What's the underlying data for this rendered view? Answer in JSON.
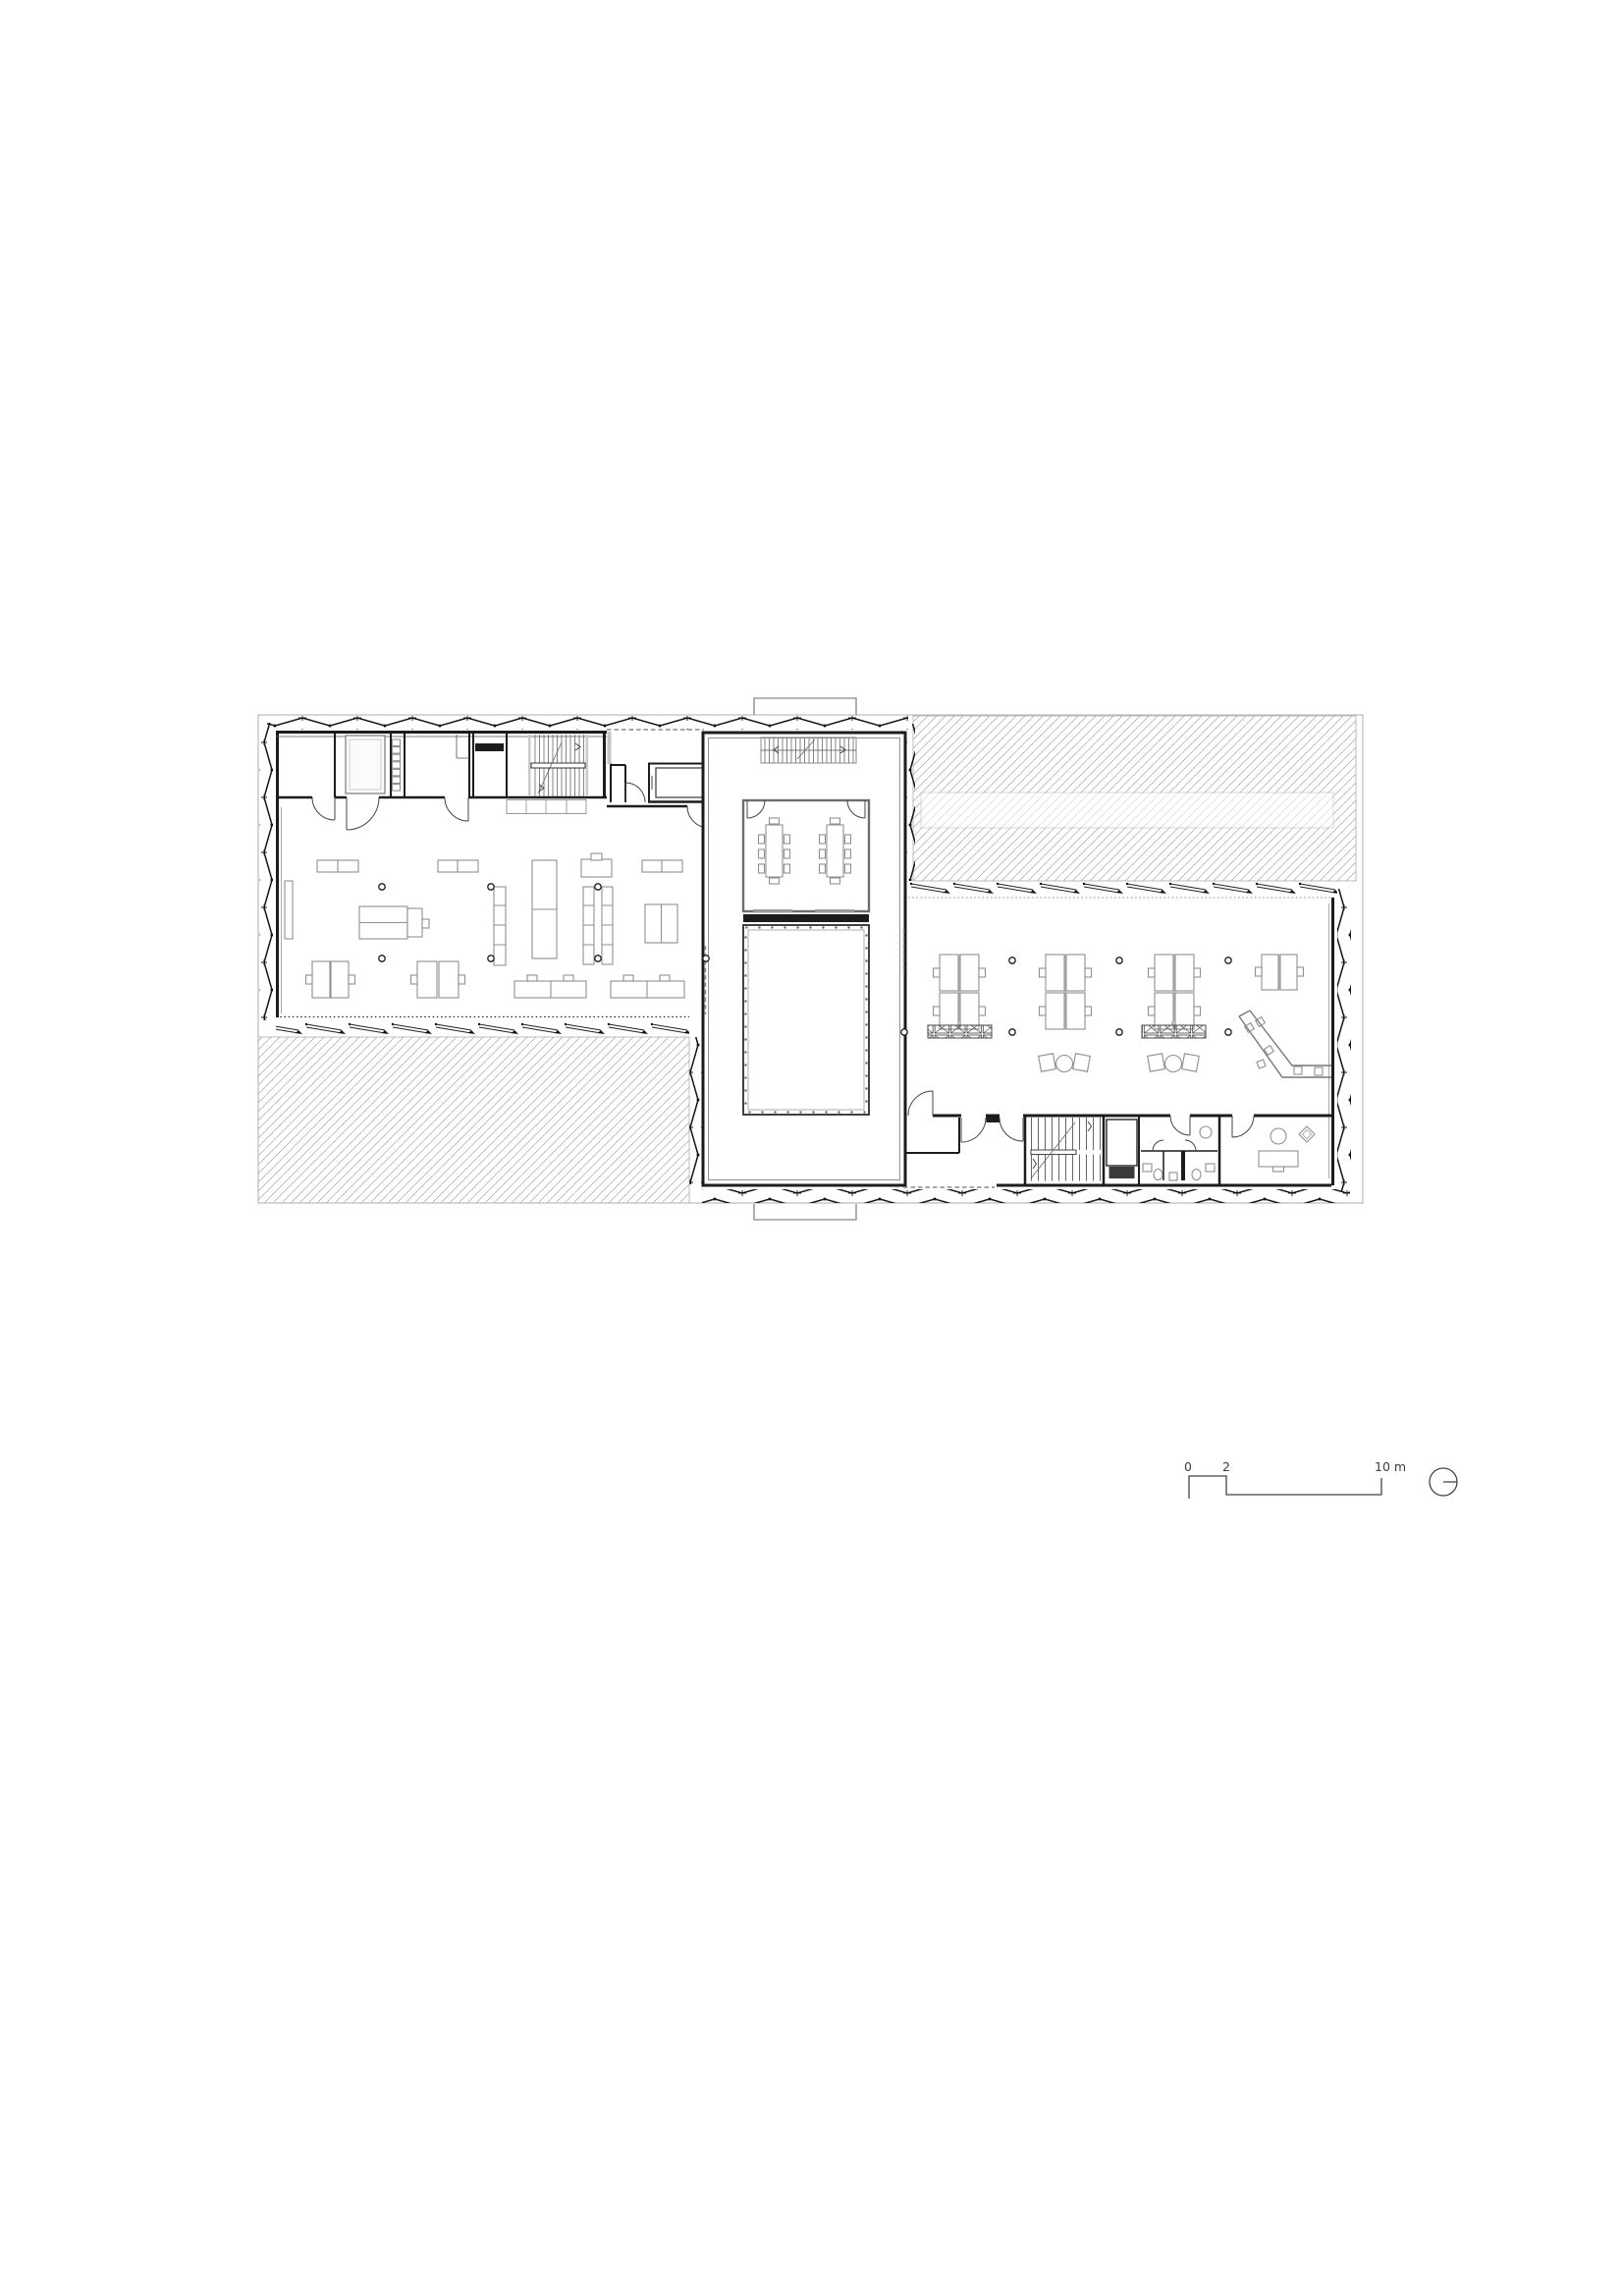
{
  "scalebar": {
    "zero": "0",
    "two": "2",
    "ten_m": "10 m"
  },
  "north_indicator": {
    "icon": "north-arrow-icon"
  },
  "colors": {
    "line": "#1c1c1c",
    "furniture": "#8f8f8f",
    "muted": "#999999",
    "hatch": "#b3b3b3",
    "canopy": "#9c9c9c",
    "background": "#ffffff"
  }
}
